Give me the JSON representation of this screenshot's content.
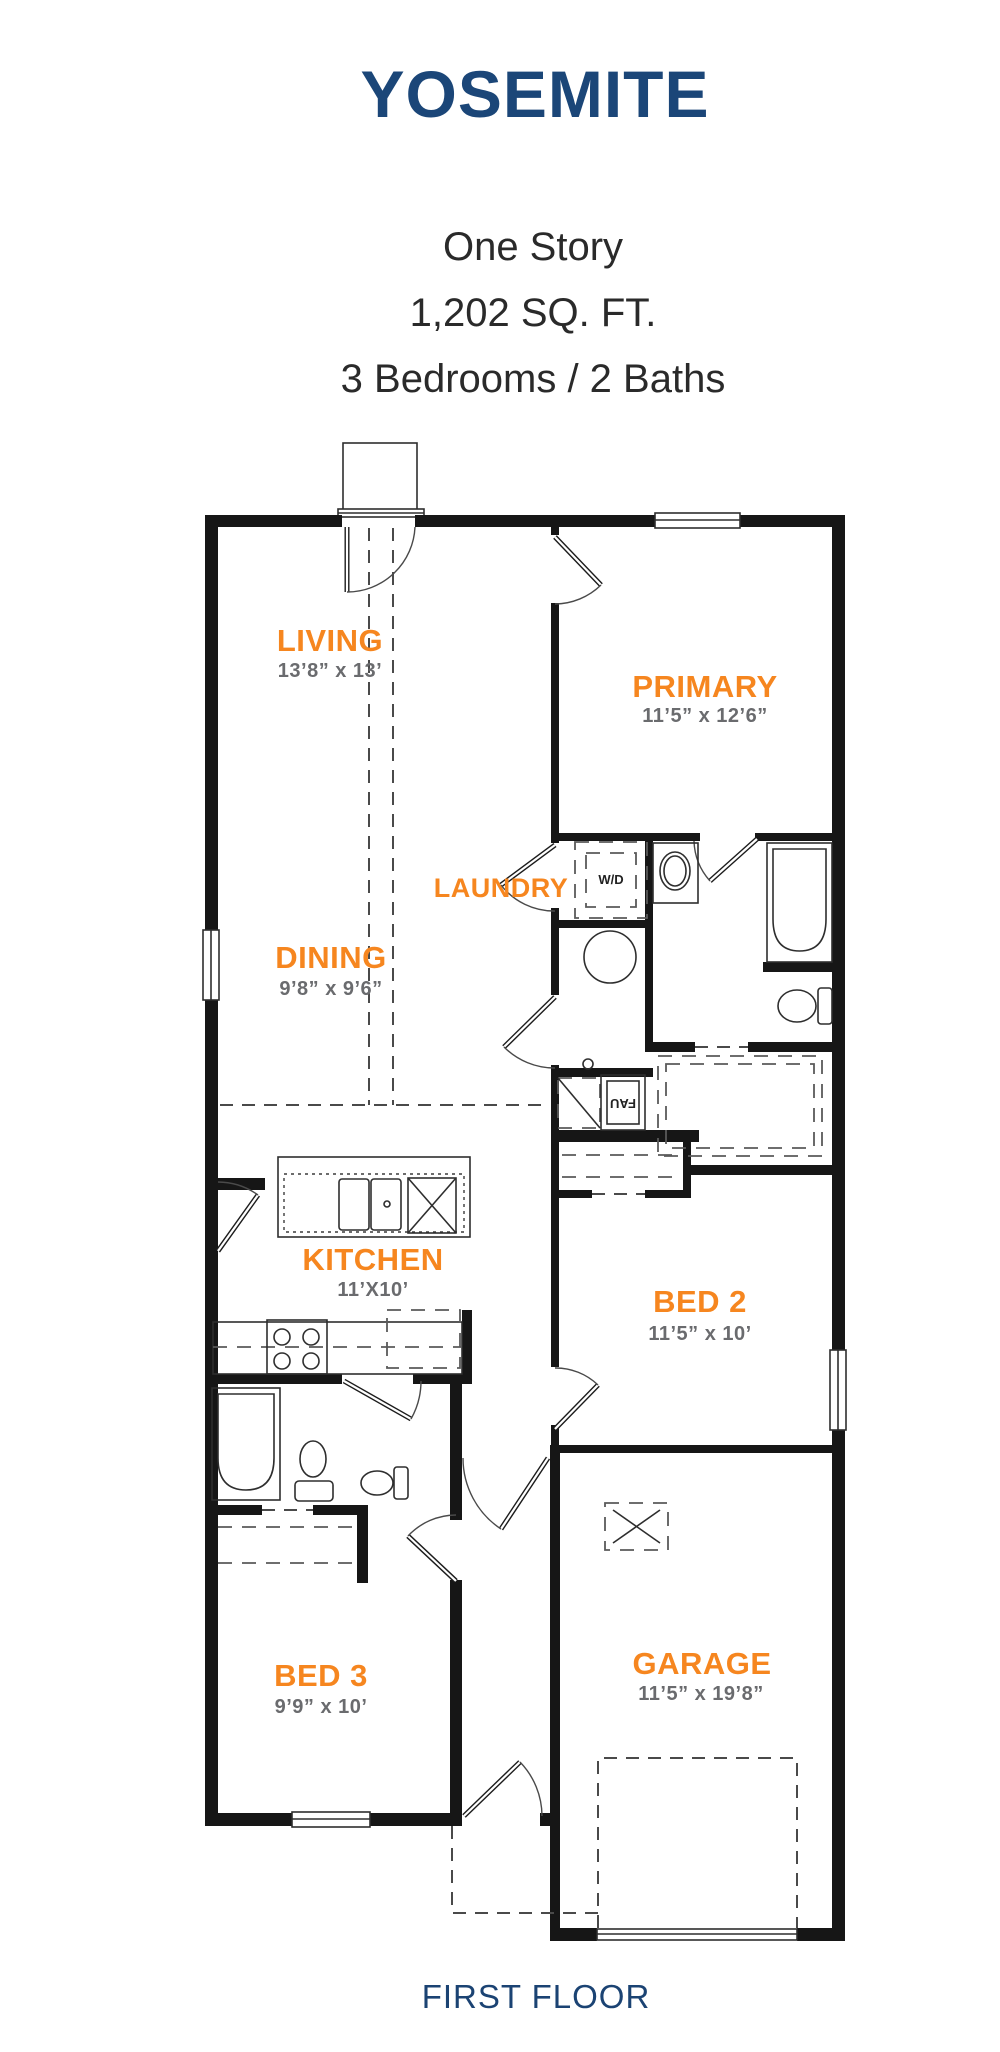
{
  "header": {
    "title": "YOSEMITE",
    "subtitle_lines": [
      "One Story",
      "1,202 SQ. FT.",
      "3 Bedrooms / 2 Baths"
    ]
  },
  "footer": {
    "label": "FIRST FLOOR"
  },
  "rooms": {
    "living": {
      "name": "LIVING",
      "dims": "13’8” x 13’"
    },
    "primary": {
      "name": "PRIMARY",
      "dims": "11’5” x 12’6”"
    },
    "dining": {
      "name": "DINING",
      "dims": "9’8” x 9’6”"
    },
    "laundry": {
      "name": "LAUNDRY"
    },
    "kitchen": {
      "name": "KITCHEN",
      "dims": "11’X10’"
    },
    "bed2": {
      "name": "BED 2",
      "dims": "11’5” x 10’"
    },
    "bed3": {
      "name": "BED 3",
      "dims": "9’9” x 10’"
    },
    "garage": {
      "name": "GARAGE",
      "dims": "11’5” x 19’8”"
    }
  },
  "appliances": {
    "washer_dryer": "W/D",
    "forced_air_unit": "FAU"
  },
  "colors": {
    "accent_orange": "#F6861F",
    "heading_navy": "#1B4678",
    "footer_navy": "#1B4373",
    "dimension_gray": "#6A6B6E",
    "wall_black": "#161616"
  },
  "plan_meta": {
    "bedrooms": "3",
    "baths": "2",
    "square_feet": "1,202",
    "stories": "One Story"
  }
}
